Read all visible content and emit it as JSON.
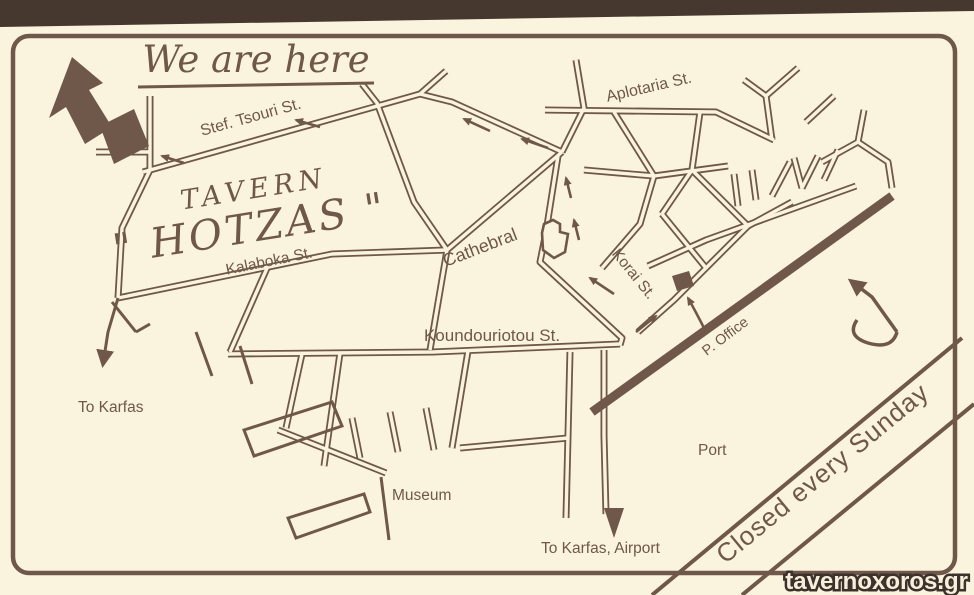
{
  "colors": {
    "paper": "#faf4de",
    "ink": "#6f5849",
    "ink_dark": "#46382f",
    "watermark_fill": "#f6efdb",
    "watermark_outline": "#3c322b"
  },
  "header": {
    "we_are_here": "We are here"
  },
  "labels": {
    "stef_tsouri": "Stef. Tsouri St.",
    "aplotaria": "Aplotaria St.",
    "kalaboka": "Kalaboka St.",
    "korai": "Korai St.",
    "koundouriotou": "Koundouriotou St.",
    "tavern_line1": "TAVERN",
    "tavern_line2": "\" HOTZAS \"",
    "cathedral": "Cathebral",
    "post_office": "P. Office",
    "port": "Port",
    "museum": "Museum",
    "to_karfas": "To Karfas",
    "to_karfas_airport": "To Karfas, Airport"
  },
  "banner": {
    "closed_text": "Closed every Sunday"
  },
  "watermark": {
    "text": "tavernoxoros.gr"
  },
  "icons": [
    "we-are-here-arrow",
    "tavern-building-marker",
    "church-outline-icon",
    "post-office-building-marker",
    "north-arrow-icon",
    "one-way-arrows",
    "to-karfas-arrow",
    "to-airport-arrow"
  ]
}
